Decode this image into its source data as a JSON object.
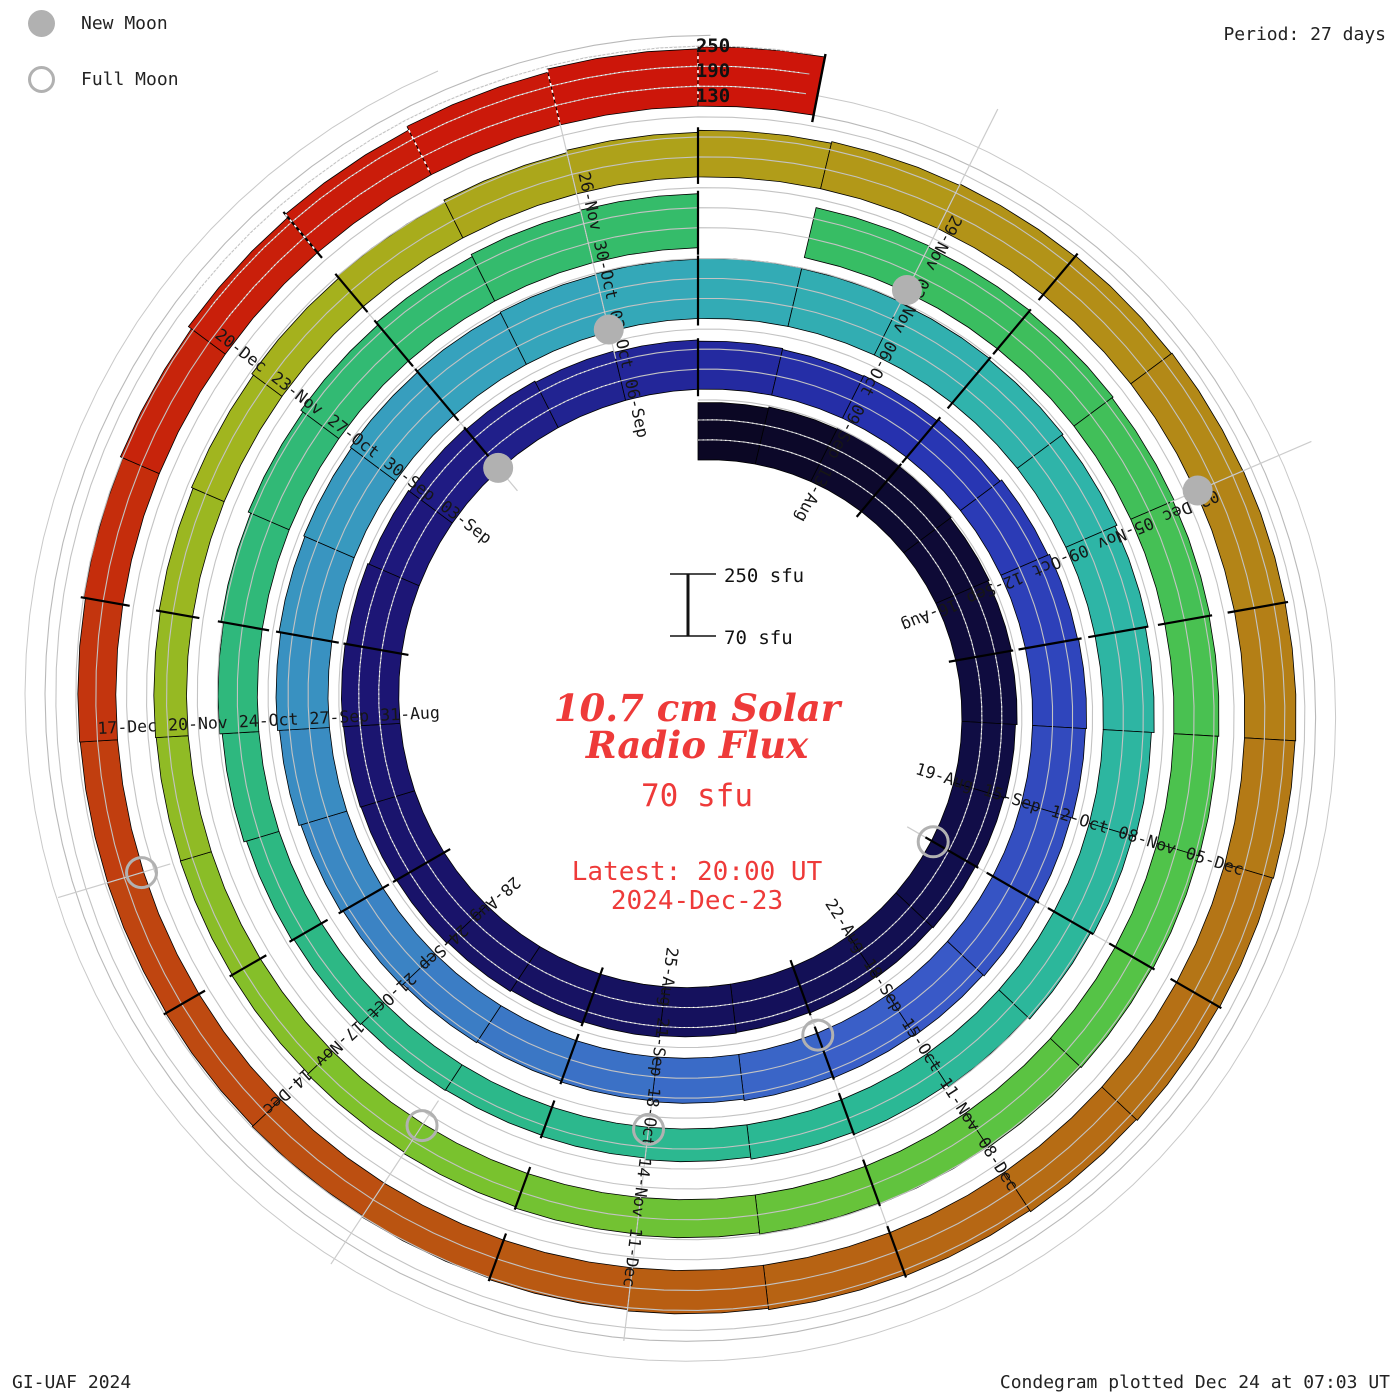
{
  "legend": {
    "items": [
      {
        "id": "new-moon",
        "label": "New Moon"
      },
      {
        "id": "full-moon",
        "label": "Full Moon"
      }
    ]
  },
  "header": {
    "period_label": "Period: 27 days"
  },
  "radial_scale_labels": [
    "250",
    "190",
    "130"
  ],
  "center": {
    "scale_bar": {
      "top_label": "250 sfu",
      "bottom_label": "70 sfu"
    },
    "title_line1": "10.7 cm Solar",
    "title_line2": "Radio Flux",
    "current_value": "70 sfu",
    "latest_line1": "Latest: 20:00 UT",
    "latest_line2": "2024-Dec-23"
  },
  "footer": {
    "left": "GI-UAF 2024",
    "right": "Condegram plotted Dec 24 at 07:03 UT"
  },
  "chart_data": {
    "type": "bar",
    "subtype": "polar-spiral-condegram",
    "title": "10.7 cm Solar Radio Flux",
    "period_days": 27,
    "start_date": "2024-08-10",
    "end_date": "2024-12-23",
    "end_day_fraction": 0.83,
    "flux_scale": {
      "baseline_sfu": 70,
      "max_sfu": 250,
      "gridlines_sfu": [
        130,
        190,
        250
      ]
    },
    "flux_daily": [
      242,
      246,
      250,
      248,
      244,
      240,
      236,
      231,
      227,
      223,
      220,
      218,
      216,
      218,
      222,
      227,
      231,
      235,
      238,
      240,
      242,
      238,
      234,
      230,
      226,
      222,
      218,
      214,
      211,
      213,
      218,
      224,
      229,
      232,
      229,
      225,
      221,
      217,
      213,
      209,
      205,
      202,
      200,
      203,
      208,
      214,
      220,
      226,
      231,
      235,
      239,
      242,
      245,
      248,
      250,
      248,
      245,
      241,
      237,
      231,
      223,
      215,
      206,
      197,
      189,
      181,
      174,
      168,
      163,
      160,
      162,
      166,
      172,
      180,
      188,
      196,
      204,
      212,
      220,
      227,
      232,
      null,
      224,
      220,
      216,
      212,
      208,
      205,
      202,
      200,
      197,
      194,
      191,
      188,
      184,
      180,
      176,
      172,
      169,
      167,
      166,
      168,
      172,
      177,
      183,
      190,
      197,
      204,
      210,
      215,
      219,
      222,
      224,
      225,
      224,
      222,
      219,
      216,
      212,
      208,
      204,
      200,
      196,
      192,
      188,
      185,
      183,
      182,
      184,
      189,
      197,
      208,
      220,
      232,
      242,
      248
    ],
    "tick_labels": [
      {
        "day_index": 3,
        "label": "13-Aug"
      },
      {
        "day_index": 6,
        "label": "16-Aug"
      },
      {
        "day_index": 9,
        "label": "19-Aug"
      },
      {
        "day_index": 12,
        "label": "22-Aug"
      },
      {
        "day_index": 15,
        "label": "25-Aug"
      },
      {
        "day_index": 18,
        "label": "28-Aug"
      },
      {
        "day_index": 21,
        "label": "31-Aug"
      },
      {
        "day_index": 24,
        "label": "03-Sep"
      },
      {
        "day_index": 27,
        "label": "06-Sep"
      },
      {
        "day_index": 30,
        "label": "09-Sep"
      },
      {
        "day_index": 33,
        "label": "12-Sep"
      },
      {
        "day_index": 36,
        "label": "15-Sep"
      },
      {
        "day_index": 39,
        "label": "18-Sep"
      },
      {
        "day_index": 42,
        "label": "21-Sep"
      },
      {
        "day_index": 45,
        "label": "24-Sep"
      },
      {
        "day_index": 48,
        "label": "27-Sep"
      },
      {
        "day_index": 51,
        "label": "30-Sep"
      },
      {
        "day_index": 54,
        "label": "03-Oct"
      },
      {
        "day_index": 57,
        "label": "06-Oct"
      },
      {
        "day_index": 60,
        "label": "09-Oct"
      },
      {
        "day_index": 63,
        "label": "12-Oct"
      },
      {
        "day_index": 66,
        "label": "15-Oct"
      },
      {
        "day_index": 69,
        "label": "18-Oct"
      },
      {
        "day_index": 72,
        "label": "21-Oct"
      },
      {
        "day_index": 75,
        "label": "24-Oct"
      },
      {
        "day_index": 78,
        "label": "27-Oct"
      },
      {
        "day_index": 81,
        "label": "30-Oct"
      },
      {
        "day_index": 84,
        "label": "02-Nov"
      },
      {
        "day_index": 87,
        "label": "05-Nov"
      },
      {
        "day_index": 90,
        "label": "08-Nov"
      },
      {
        "day_index": 93,
        "label": "11-Nov"
      },
      {
        "day_index": 96,
        "label": "14-Nov"
      },
      {
        "day_index": 99,
        "label": "17-Nov"
      },
      {
        "day_index": 102,
        "label": "20-Nov"
      },
      {
        "day_index": 105,
        "label": "23-Nov"
      },
      {
        "day_index": 108,
        "label": "26-Nov"
      },
      {
        "day_index": 111,
        "label": "29-Nov"
      },
      {
        "day_index": 114,
        "label": "02-Dec"
      },
      {
        "day_index": 117,
        "label": "05-Dec"
      },
      {
        "day_index": 120,
        "label": "08-Dec"
      },
      {
        "day_index": 123,
        "label": "11-Dec"
      },
      {
        "day_index": 126,
        "label": "14-Dec"
      },
      {
        "day_index": 129,
        "label": "17-Dec"
      },
      {
        "day_index": 132,
        "label": "20-Dec"
      }
    ],
    "moons": [
      {
        "day_index": 9,
        "phase": "full"
      },
      {
        "day_index": 24,
        "phase": "new"
      },
      {
        "day_index": 39,
        "phase": "full"
      },
      {
        "day_index": 53,
        "phase": "new"
      },
      {
        "day_index": 68,
        "phase": "full"
      },
      {
        "day_index": 83,
        "phase": "new"
      },
      {
        "day_index": 97,
        "phase": "full"
      },
      {
        "day_index": 113,
        "phase": "new"
      },
      {
        "day_index": 127,
        "phase": "full"
      }
    ],
    "colors": {
      "moon_gray": "#b1b1b1",
      "grid_gray": "#c3c3c3",
      "annotation_red": "#ee3a39",
      "time_color_stops": [
        [
          0,
          "#0b0722"
        ],
        [
          12,
          "#131058"
        ],
        [
          22,
          "#1d1678"
        ],
        [
          30,
          "#2733b2"
        ],
        [
          38,
          "#3a5cc8"
        ],
        [
          45,
          "#3b86c4"
        ],
        [
          52,
          "#36a4bc"
        ],
        [
          58,
          "#2fb4aa"
        ],
        [
          66,
          "#2bb894"
        ],
        [
          74,
          "#2eb87e"
        ],
        [
          83,
          "#38bd62"
        ],
        [
          90,
          "#52c348"
        ],
        [
          97,
          "#7cc22c"
        ],
        [
          104,
          "#a4b41e"
        ],
        [
          109,
          "#b29a18"
        ],
        [
          116,
          "#b47716"
        ],
        [
          122,
          "#b85c12"
        ],
        [
          127,
          "#c04210"
        ],
        [
          131,
          "#c8200a"
        ],
        [
          135,
          "#cc150a"
        ]
      ]
    },
    "notes": "Archimedean spiral, one revolution = 27 days, clockwise from top; bar height = daily F10.7 flux above 70 sfu baseline; data gap on 30-Oct; spiral runs 10-Aug-2024 to 23-Dec-2024 20:00 UT."
  }
}
